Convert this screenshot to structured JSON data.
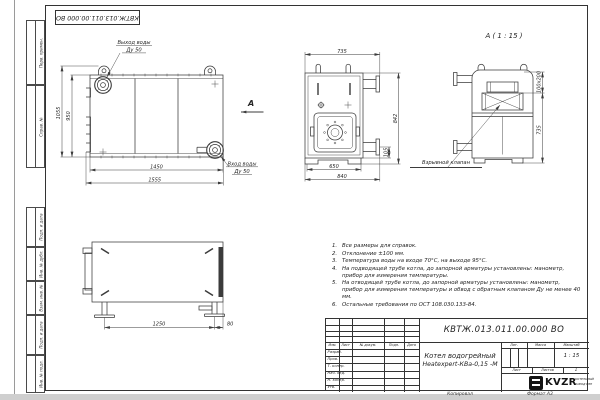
{
  "sheet": {
    "doc_number": "КВТЖ.013.011.00.000 ВО",
    "copied_label": "Копировал",
    "format_label": "Формат А3"
  },
  "colors": {
    "line": "#3b3b3b",
    "text": "#222222",
    "paper": "#ffffff"
  },
  "margin": {
    "cells": [
      "Перв. примен.",
      "Справ. №",
      "Подп. и дата",
      "Инв. № дубл.",
      "Взам. инв. №",
      "Подп. и дата",
      "Инв. № подл."
    ]
  },
  "front_view": {
    "outlet_label_1": "Выход воды",
    "outlet_label_2": "Ду 50",
    "inlet_label_1": "Вход воды",
    "inlet_label_2": "Ду 50",
    "view_arrow": "А",
    "dim_total_height": "1055",
    "dim_body_height": "950",
    "dim_body_width": "1450",
    "dim_total_width": "1555"
  },
  "side_view": {
    "dim_top_width": "735",
    "dim_base_width": "650",
    "dim_total_width": "840",
    "dim_height": "842",
    "dim_base_height": "105"
  },
  "section_view": {
    "title": "А ( 1 : 15 )",
    "valve_label": "Взрывной клапан",
    "dim_valve": "100х200",
    "dim_height": "735"
  },
  "top_view": {
    "dim_leg_span": "1250",
    "dim_leg_offset": "80"
  },
  "notes": [
    {
      "num": "1.",
      "text": "Все размеры для справок."
    },
    {
      "num": "2.",
      "text": "Отклонение ±100 мм."
    },
    {
      "num": "3.",
      "text": "Температура воды на входе 70°С, на выходе 95°С."
    },
    {
      "num": "4.",
      "text": "На подводящей трубе котла, до запорной арматуры установлены: манометр, прибор для измерения температуры."
    },
    {
      "num": "5.",
      "text": "На отводящей трубе котла, до запорной арматуры установлены: манометр, прибор для измерения температуры и обвод с обратным клапаном Ду не менее 40 мм."
    },
    {
      "num": "6.",
      "text": "Остальные требования по ОСТ 108.030.133-84."
    }
  ],
  "title_block": {
    "doc_number": "КВТЖ.013.011.00.000 ВО",
    "product_line1": "Котел водогрейный",
    "product_line2": "Heatexpert-КВа-0,15 -М",
    "header_cols": [
      "Изм.",
      "Лист",
      "№ докум.",
      "Подп.",
      "Дата"
    ],
    "rows": [
      "Разраб.",
      "Пров.",
      "Т. контр.",
      "Нач. отд.",
      "Н. контр.",
      "Утв."
    ],
    "lit_label": "Лит.",
    "mass_label": "Масса",
    "scale_label": "Масштаб",
    "scale_value": "1 : 15",
    "sheet_label": "Лист",
    "sheets_label": "Листов",
    "sheets_value": "1",
    "logo_text": "KVZR",
    "company_line1": "КОТЕЛЬНЫЙ",
    "company_line2": "ЗАВОД РЭП"
  }
}
